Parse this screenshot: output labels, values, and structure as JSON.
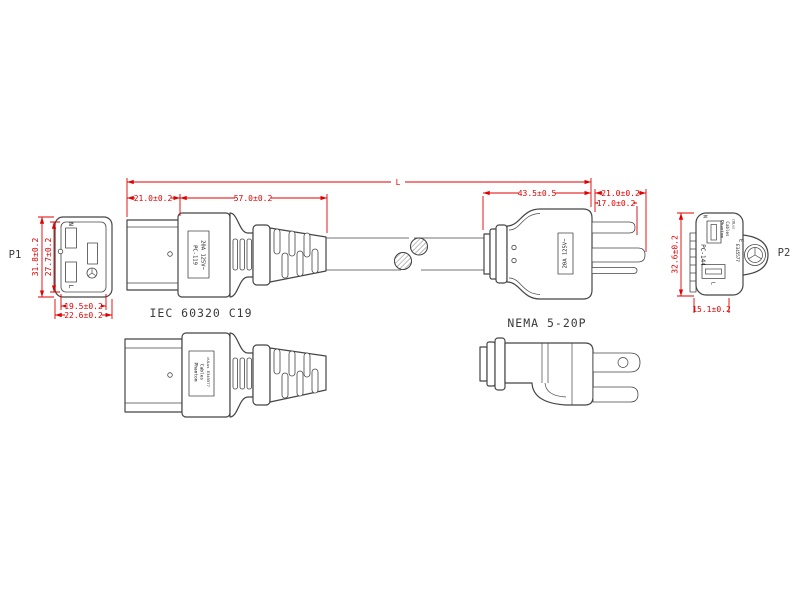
{
  "drawing": {
    "p1_label": "P1",
    "p2_label": "P2",
    "length_label": "L",
    "c19_name": "IEC 60320 C19",
    "nema_name": "NEMA 5-20P",
    "p1": {
      "pin_n": "N",
      "pin_l": "L",
      "outer_height": "31.8±0.2",
      "inner_height": "27.7±0.2",
      "inner_width": "19.5±0.2",
      "outer_width": "22.6±0.2"
    },
    "c19_side": {
      "part_no": "PC-119",
      "rating": "20A 125V~",
      "sleeve_len": "21.0±0.2",
      "body_len": "57.0±0.2"
    },
    "nema_side": {
      "rating": "20A 125V~",
      "body_len": "43.5±0.5",
      "blade_len_long": "21.0±0.2",
      "blade_len_short": "17.0±0.2"
    },
    "c19_bottom": {
      "brand1": "Phantom",
      "brand2": "Cables",
      "ul": "cULus E345577"
    },
    "p2": {
      "pin_n": "N",
      "pin_l": "L",
      "pin_e": "E",
      "part_no": "PC-144",
      "brand1": "Phantom",
      "brand2": "Cables",
      "ul_mark": "cULus",
      "ul_file": "E345577",
      "height": "32.6±0.2",
      "width": "15.1±0.2"
    }
  },
  "colors": {
    "dimension": "#e10000",
    "line": "#454545",
    "background": "#ffffff"
  }
}
